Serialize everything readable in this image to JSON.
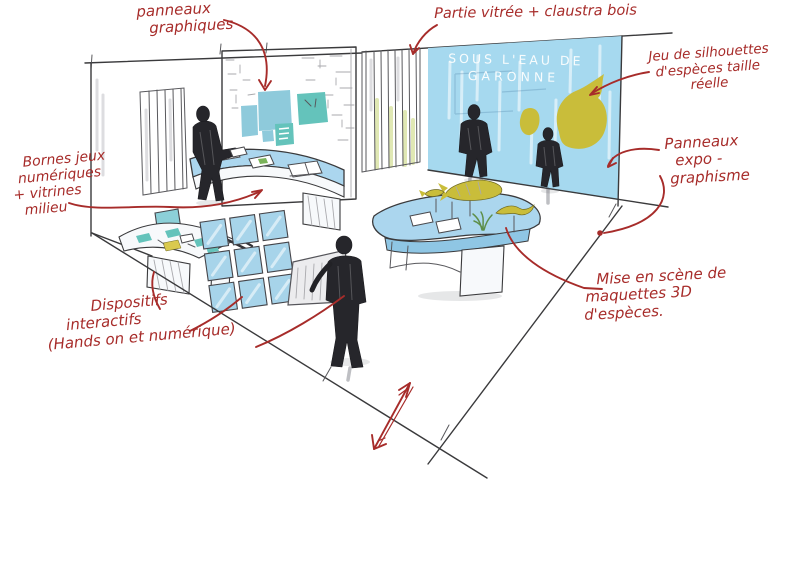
{
  "wall_title": [
    "SOUS L'EAU DE",
    "GARONNE"
  ],
  "annotations": {
    "panneaux_graphiques": [
      "panneaux",
      "graphiques"
    ],
    "partie_vitree": [
      "Partie vitrée + claustra bois"
    ],
    "jeu_silhouettes": [
      "Jeu de silhouettes",
      "d'espèces taille",
      "réelle"
    ],
    "panneaux_expo": [
      "Panneaux",
      "expo -",
      "graphisme"
    ],
    "bornes_jeux": [
      "Bornes jeux",
      "numériques",
      "+ vitrines",
      "milieu"
    ],
    "dispositifs": [
      "Dispositifs",
      "interactifs",
      "(Hands on et numérique)"
    ],
    "mise_en_scene": [
      "Mise en scène de",
      "maquettes 3D",
      "d'espèces."
    ]
  },
  "colors": {
    "ink_red": "#a72c2a",
    "line_ink": "#3a3a3c",
    "wall_blue": "#a6d9ef",
    "note_blue": "#8ecadb",
    "note_teal": "#64c3bb",
    "tile_blue": "#a7d4ea",
    "table_blue": "#abd6ee",
    "fish_olive": "#c9bd3a",
    "card_yellow": "#d9c94e"
  }
}
